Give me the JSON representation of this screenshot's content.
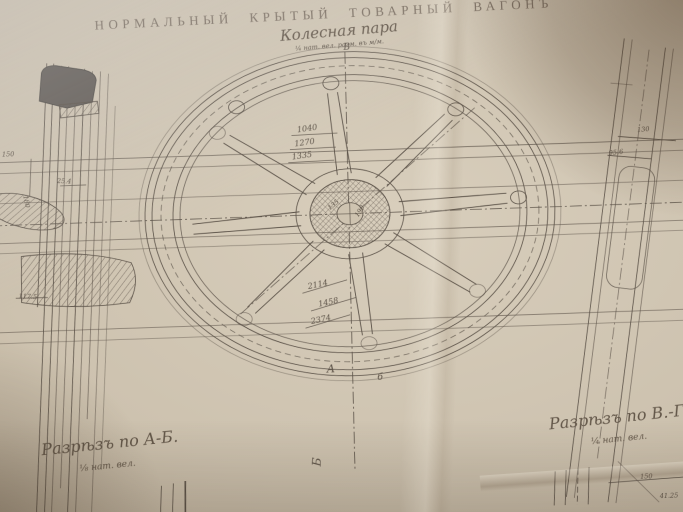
{
  "title": "НОРМАЛЬНЫЙ КРЫТЫЙ ТОВАРНЫЙ ВАГОНЪ",
  "subtitle": "Колесная пара",
  "subtitle_scale": "¼ нат. вел. разм. въ м/м.",
  "wheel": {
    "dim_radii": [
      "1040",
      "1270",
      "1335"
    ],
    "dim_widths": [
      "2114",
      "1458",
      "2374"
    ],
    "hub_dim_left": "135",
    "hub_dim_right": "190",
    "marker_top": "В",
    "marker_a": "А",
    "marker_b_small": "б",
    "marker_bottom": "Б"
  },
  "left_view": {
    "dims": [
      "150",
      "180",
      "25.4",
      "117.5"
    ]
  },
  "right_view": {
    "dims": [
      "130",
      "95.6"
    ]
  },
  "bottom_right": {
    "dims": [
      "150",
      "41.25"
    ]
  },
  "sections": {
    "left_label": "Разрѣзъ по А-Б.",
    "left_scale": "⅛ нат. вел.",
    "right_label": "Разрѣзъ по В.-Г.",
    "right_scale": "¼ нат. вел."
  },
  "colors": {
    "paper": "#cdc2af",
    "line": "#4e453c",
    "ink": "#6e6154",
    "dark_fill": "#55504b"
  }
}
